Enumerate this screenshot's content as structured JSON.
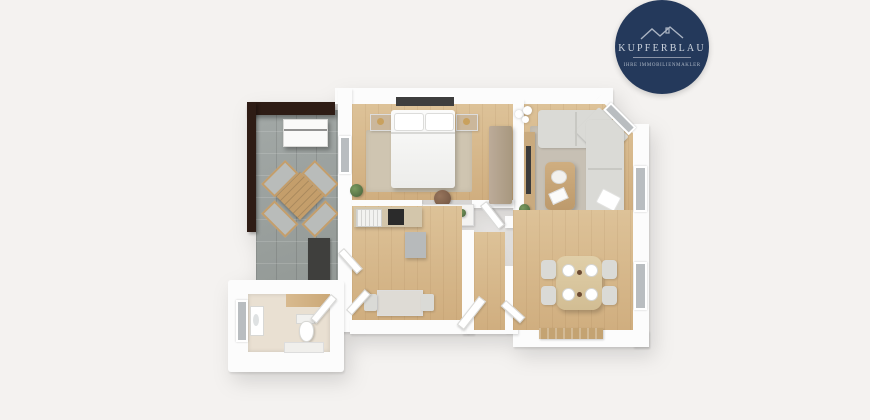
{
  "logo": {
    "brand": "KUPFERBLAU",
    "tagline": "IHRE IMMOBILIENMAKLER"
  },
  "colors": {
    "bg": "#f4f2f0",
    "wall": "#fcfcfc",
    "wood": "#d7b68c",
    "tile": "#9ba19f",
    "pergola": "#2e1c15",
    "sofa": "#dadad6",
    "navy": "#24395b",
    "logo-text": "#ccd3dd",
    "table-wood": "#c49e6b",
    "mat-tan": "#c4a372",
    "green": "#5d7a4e"
  },
  "floorplan": {
    "view": "3d-top-down-render",
    "rooms": [
      {
        "id": "terrace",
        "floor": "grey-stone-tiles",
        "furniture": [
          "pergola-beams",
          "white-slatted-unit",
          "outdoor-dining-set-rotated",
          "dark-doormat"
        ]
      },
      {
        "id": "bedroom",
        "floor": "light-wood",
        "furniture": [
          "double-bed-white",
          "nightstand-with-lamp-left",
          "nightstand-with-lamp-right",
          "wardrobe",
          "beige-rug",
          "desk",
          "round-stool",
          "plant"
        ]
      },
      {
        "id": "living-room",
        "floor": "light-wood",
        "furniture": [
          "l-shaped-corner-sofa",
          "coffee-table",
          "area-rug",
          "tv-sideboard",
          "ceiling-lamp",
          "plant",
          "white-cushion"
        ]
      },
      {
        "id": "kitchen",
        "floor": "light-wood",
        "furniture": [
          "counter-with-sink",
          "black-cooktop",
          "grey-cabinet",
          "small-table-with-two-chairs"
        ]
      },
      {
        "id": "dining-room",
        "floor": "light-wood",
        "furniture": [
          "dining-table",
          "four-chairs",
          "four-place-settings",
          "tan-doormat"
        ]
      },
      {
        "id": "bathroom",
        "floor": "white-wood-accent",
        "furniture": [
          "toilet",
          "washbasin",
          "bath-mat",
          "window"
        ]
      },
      {
        "id": "hallway",
        "furniture": [
          "entrance-door-open",
          "interior-doors"
        ]
      }
    ]
  }
}
